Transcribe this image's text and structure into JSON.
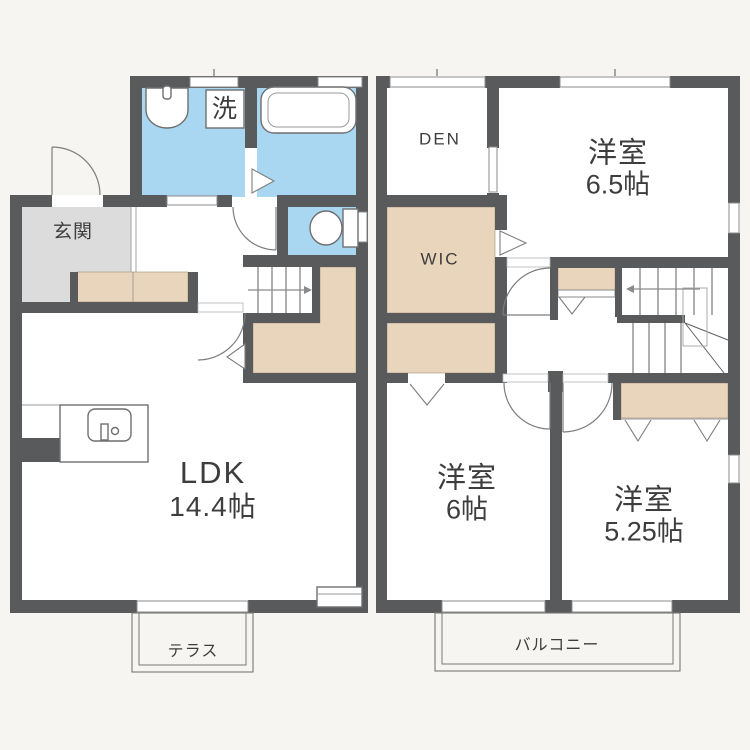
{
  "document": {
    "type": "floor-plan",
    "floors": [
      "1F",
      "2F"
    ]
  },
  "floor1": {
    "entrance_label": "玄関",
    "laundry_label": "洗",
    "ldk_label": "LDK",
    "ldk_size": "14.4帖",
    "terrace_label": "テラス"
  },
  "floor2": {
    "den_label": "DEN",
    "wic_label": "WIC",
    "bedroom_a_label": "洋室",
    "bedroom_a_size": "6.5帖",
    "bedroom_b_label": "洋室",
    "bedroom_b_size": "6帖",
    "bedroom_c_label": "洋室",
    "bedroom_c_size": "5.25帖",
    "balcony_label": "バルコニー"
  },
  "colors": {
    "wall": "#595a5c",
    "wet_area_blue": "#a9d6f0",
    "closet_tan": "#e9d5bc",
    "entrance_gray": "#dcdcdd",
    "room_white": "#ffffff",
    "background": "#f6f5f2"
  }
}
